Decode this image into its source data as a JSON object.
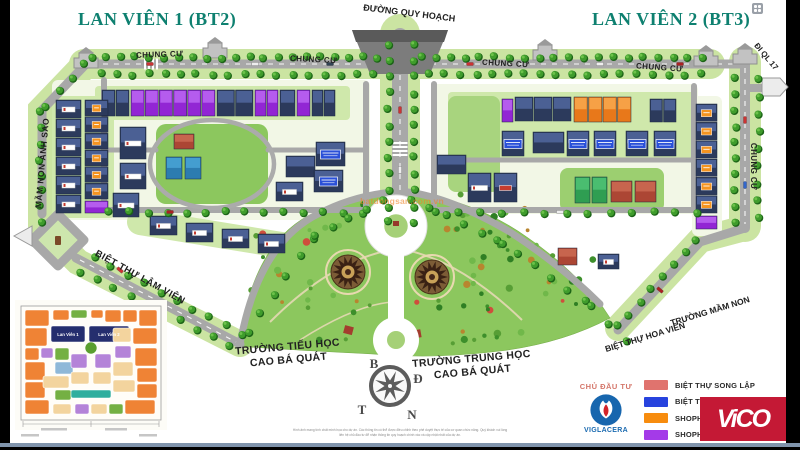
{
  "titles": {
    "project_left": "LAN VIÊN 1 (BT2)",
    "project_right": "LAN VIÊN 2 (BT3)"
  },
  "map_labels": {
    "duong_quy_hoach": "ĐƯỜNG QUY HOẠCH",
    "chung_cu": "CHUNG CƯ",
    "di_ql_17": "ĐI QL 17",
    "mam_non_anh_sao": "MẦM NON ÁNH SAO",
    "biet_thu_lam_vien": "BIỆT THỰ LÂM VIÊN",
    "biet_thu_hoa_vien": "BIỆT THỰ HOA VIÊN",
    "truong_mam_non": "TRƯỜNG MẦM NON",
    "school_primary_line1": "TRƯỜNG TIỂU HỌC",
    "school_primary_line2": "CAO BÁ QUÁT",
    "school_secondary_line1": "TRƯỜNG TRUNG HỌC",
    "school_secondary_line2": "CAO BÁ QUÁT"
  },
  "compass": {
    "north": "B",
    "east": "Đ",
    "south": "N",
    "west": "T"
  },
  "inset_map": {
    "block_1_label": "Lan Viên 1",
    "block_2_label": "Lan Viên 2"
  },
  "developer": {
    "heading": "CHỦ ĐẦU TƯ",
    "name": "VIGLACERA"
  },
  "legend": {
    "items": [
      {
        "label": "BIỆT THỰ SONG LẬP",
        "color": "#e0736e"
      },
      {
        "label": "BIỆT THỰ ĐƠ",
        "color": "#2743de"
      },
      {
        "label": "SHOPHOUSE",
        "color": "#f78c0e"
      },
      {
        "label": "SHOPHOUSE",
        "color": "#a43ae8"
      }
    ]
  },
  "brand": {
    "vico": "ViCO"
  },
  "watermark": "batdongsan.com.vn",
  "disclaimer": {
    "line1": "Hình ảnh mang tính chất minh họa cho dự án. Các thông tin có thể được điều chỉnh theo phê duyệt thực tế của cơ quan chức năng. Quý khách vui lòng",
    "line2": "liên hệ chủ đầu tư để nhận thông tin quy hoạch chính xác và cập nhật nhất của dự án."
  }
}
